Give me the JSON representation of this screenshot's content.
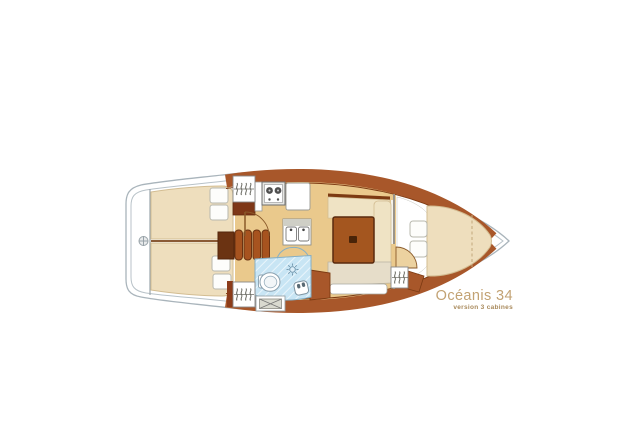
{
  "brand": {
    "model": "Océanis 34",
    "version": "version 3 cabines"
  },
  "diagram": {
    "type": "sailboat-interior-floor-plan",
    "orientation": "bow-right-stern-left",
    "rooms": [
      "port-aft-cabin",
      "starboard-aft-cabin",
      "galley",
      "saloon",
      "head-with-shower",
      "forward-v-berth-cabin"
    ],
    "depicted_features": [
      "twin-aft-double-berths-with-pillows",
      "companionway-steps",
      "two-burner-stove",
      "double-sink",
      "fridge-counter",
      "saloon-table",
      "settees",
      "chart-table",
      "toilet",
      "shower-head",
      "washbasin",
      "hanging-lockers",
      "engine-compartment-hatch",
      "transom-fitting"
    ]
  },
  "colors": {
    "background": "#ffffff",
    "hull_outline": "#a9b4bb",
    "wood": "#a8572a",
    "wood_dark": "#7c3a12",
    "floor": "#eac98c",
    "berth": "#eedebd",
    "settee": "#efe3c4",
    "head_blue": "#c8e5f4",
    "accent_text": "#c2a273",
    "accent_text_dark": "#a98a5c"
  }
}
